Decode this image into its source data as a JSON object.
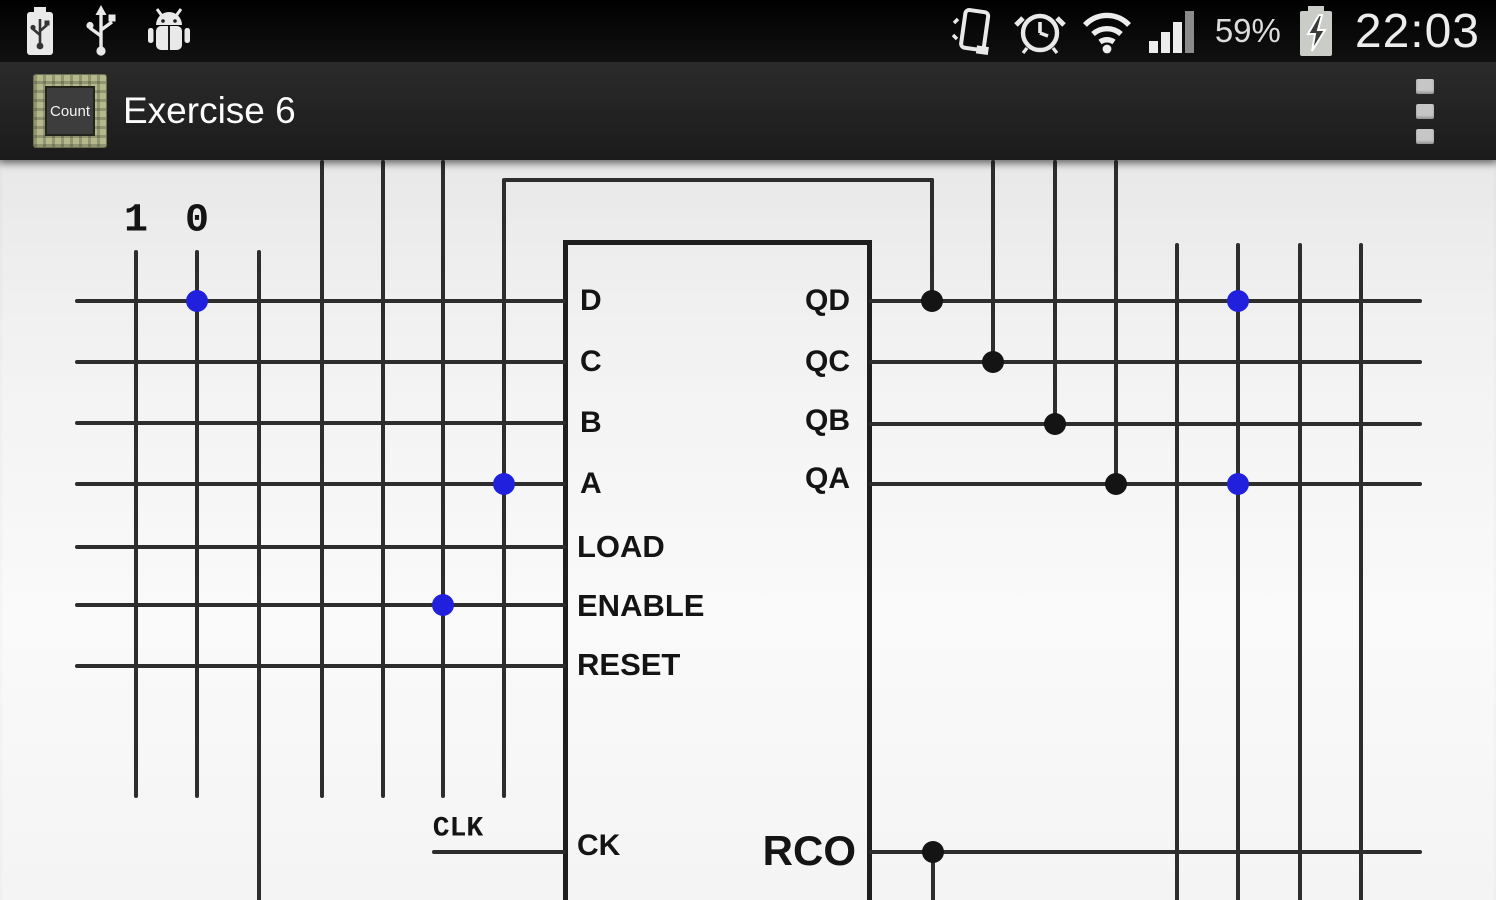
{
  "status_bar": {
    "time": "22:03",
    "battery_percent": "59%",
    "left_icons": [
      "usb-battery",
      "usb",
      "android-debug"
    ],
    "right_icons": [
      "vibrate",
      "alarm-clock",
      "wifi",
      "signal-strength",
      "battery-charging"
    ]
  },
  "action_bar": {
    "title": "Exercise 6",
    "app_icon_label": "Count"
  },
  "diagram": {
    "origin_y": 160,
    "wire_color": "#2d2d2d",
    "wire_width": 4,
    "dot_radius": 11,
    "dot_colors": {
      "blue": "#2121dd",
      "black": "#141414"
    },
    "pin_labels": [
      {
        "label": "D",
        "x": 580,
        "y": 301,
        "align": "left",
        "size": 30,
        "font": "sans"
      },
      {
        "label": "C",
        "x": 580,
        "y": 362,
        "align": "left",
        "size": 30,
        "font": "sans"
      },
      {
        "label": "B",
        "x": 580,
        "y": 423,
        "align": "left",
        "size": 30,
        "font": "sans"
      },
      {
        "label": "A",
        "x": 580,
        "y": 484,
        "align": "left",
        "size": 30,
        "font": "sans"
      },
      {
        "label": "LOAD",
        "x": 577,
        "y": 547,
        "align": "left",
        "size": 31,
        "font": "sans"
      },
      {
        "label": "ENABLE",
        "x": 577,
        "y": 606,
        "align": "left",
        "size": 31,
        "font": "sans"
      },
      {
        "label": "RESET",
        "x": 577,
        "y": 665,
        "align": "left",
        "size": 31,
        "font": "sans"
      },
      {
        "label": "CK",
        "x": 577,
        "y": 846,
        "align": "left",
        "size": 30,
        "font": "sans"
      },
      {
        "label": "QD",
        "x": 850,
        "y": 301,
        "align": "right",
        "size": 30,
        "font": "sans"
      },
      {
        "label": "QC",
        "x": 850,
        "y": 362,
        "align": "right",
        "size": 30,
        "font": "sans"
      },
      {
        "label": "QB",
        "x": 850,
        "y": 421,
        "align": "right",
        "size": 30,
        "font": "sans"
      },
      {
        "label": "QA",
        "x": 850,
        "y": 479,
        "align": "right",
        "size": 30,
        "font": "sans"
      },
      {
        "label": "RCO",
        "x": 856,
        "y": 851,
        "align": "right",
        "size": 42,
        "font": "sans"
      },
      {
        "label": "1",
        "x": 136,
        "y": 221,
        "align": "center",
        "size": 40,
        "font": "mono"
      },
      {
        "label": "0",
        "x": 197,
        "y": 221,
        "align": "center",
        "size": 40,
        "font": "mono"
      },
      {
        "label": "CLK",
        "x": 458,
        "y": 829,
        "align": "center",
        "size": 28,
        "font": "mono"
      }
    ],
    "wires": [
      {
        "id": "input-d",
        "y": 301,
        "x1": 75,
        "x2": 566
      },
      {
        "id": "input-c",
        "y": 362,
        "x1": 75,
        "x2": 566
      },
      {
        "id": "input-b",
        "y": 423,
        "x1": 75,
        "x2": 566
      },
      {
        "id": "input-a",
        "y": 484,
        "x1": 75,
        "x2": 566
      },
      {
        "id": "input-load",
        "y": 547,
        "x1": 75,
        "x2": 566
      },
      {
        "id": "input-enable",
        "y": 605,
        "x1": 75,
        "x2": 566
      },
      {
        "id": "input-reset",
        "y": 666,
        "x1": 75,
        "x2": 566
      },
      {
        "id": "clk-stub",
        "y": 852,
        "x1": 432,
        "x2": 566
      },
      {
        "id": "feedback-top",
        "y": 180,
        "x1": 504,
        "x2": 934
      },
      {
        "id": "output-qd",
        "y": 301,
        "x1": 869,
        "x2": 1422
      },
      {
        "id": "output-qc",
        "y": 362,
        "x1": 869,
        "x2": 1422
      },
      {
        "id": "output-qb",
        "y": 424,
        "x1": 869,
        "x2": 1422
      },
      {
        "id": "output-qa",
        "y": 484,
        "x1": 869,
        "x2": 1422
      },
      {
        "id": "output-rco",
        "y": 852,
        "x1": 869,
        "x2": 1422
      },
      {
        "id": "col-1",
        "x": 136,
        "y1": 250,
        "y2": 798
      },
      {
        "id": "col-0",
        "x": 197,
        "y1": 250,
        "y2": 798
      },
      {
        "id": "col-3",
        "x": 259,
        "y1": 250,
        "y2": 902
      },
      {
        "id": "col-4",
        "x": 322,
        "y1": 160,
        "y2": 798
      },
      {
        "id": "col-5",
        "x": 383,
        "y1": 160,
        "y2": 798
      },
      {
        "id": "col-6",
        "x": 443,
        "y1": 160,
        "y2": 798
      },
      {
        "id": "col-7",
        "x": 504,
        "y1": 178,
        "y2": 798
      },
      {
        "id": "qd-drop",
        "x": 932,
        "y1": 178,
        "y2": 301
      },
      {
        "id": "qc-drop",
        "x": 993,
        "y1": 160,
        "y2": 362
      },
      {
        "id": "qb-drop",
        "x": 1055,
        "y1": 160,
        "y2": 424
      },
      {
        "id": "qa-drop",
        "x": 1116,
        "y1": 160,
        "y2": 484
      },
      {
        "id": "right-col-1",
        "x": 1177,
        "y1": 243,
        "y2": 902
      },
      {
        "id": "right-col-2",
        "x": 1238,
        "y1": 243,
        "y2": 902
      },
      {
        "id": "right-col-3",
        "x": 1300,
        "y1": 243,
        "y2": 902
      },
      {
        "id": "right-col-4",
        "x": 1361,
        "y1": 243,
        "y2": 902
      },
      {
        "id": "rco-drop",
        "x": 933,
        "y1": 852,
        "y2": 902
      }
    ],
    "dots": [
      {
        "name": "d-row-col0",
        "x": 197,
        "y": 301,
        "color": "blue"
      },
      {
        "name": "a-row-col7",
        "x": 504,
        "y": 484,
        "color": "blue"
      },
      {
        "name": "enable-row-col6",
        "x": 443,
        "y": 605,
        "color": "blue"
      },
      {
        "name": "qd-row-right",
        "x": 1238,
        "y": 301,
        "color": "blue"
      },
      {
        "name": "qa-row-right",
        "x": 1238,
        "y": 484,
        "color": "blue"
      },
      {
        "name": "qd-junction",
        "x": 932,
        "y": 301,
        "color": "black"
      },
      {
        "name": "qc-junction",
        "x": 993,
        "y": 362,
        "color": "black"
      },
      {
        "name": "qb-junction",
        "x": 1055,
        "y": 424,
        "color": "black"
      },
      {
        "name": "qa-junction",
        "x": 1116,
        "y": 484,
        "color": "black"
      },
      {
        "name": "rco-junction",
        "x": 933,
        "y": 852,
        "color": "black"
      }
    ]
  }
}
